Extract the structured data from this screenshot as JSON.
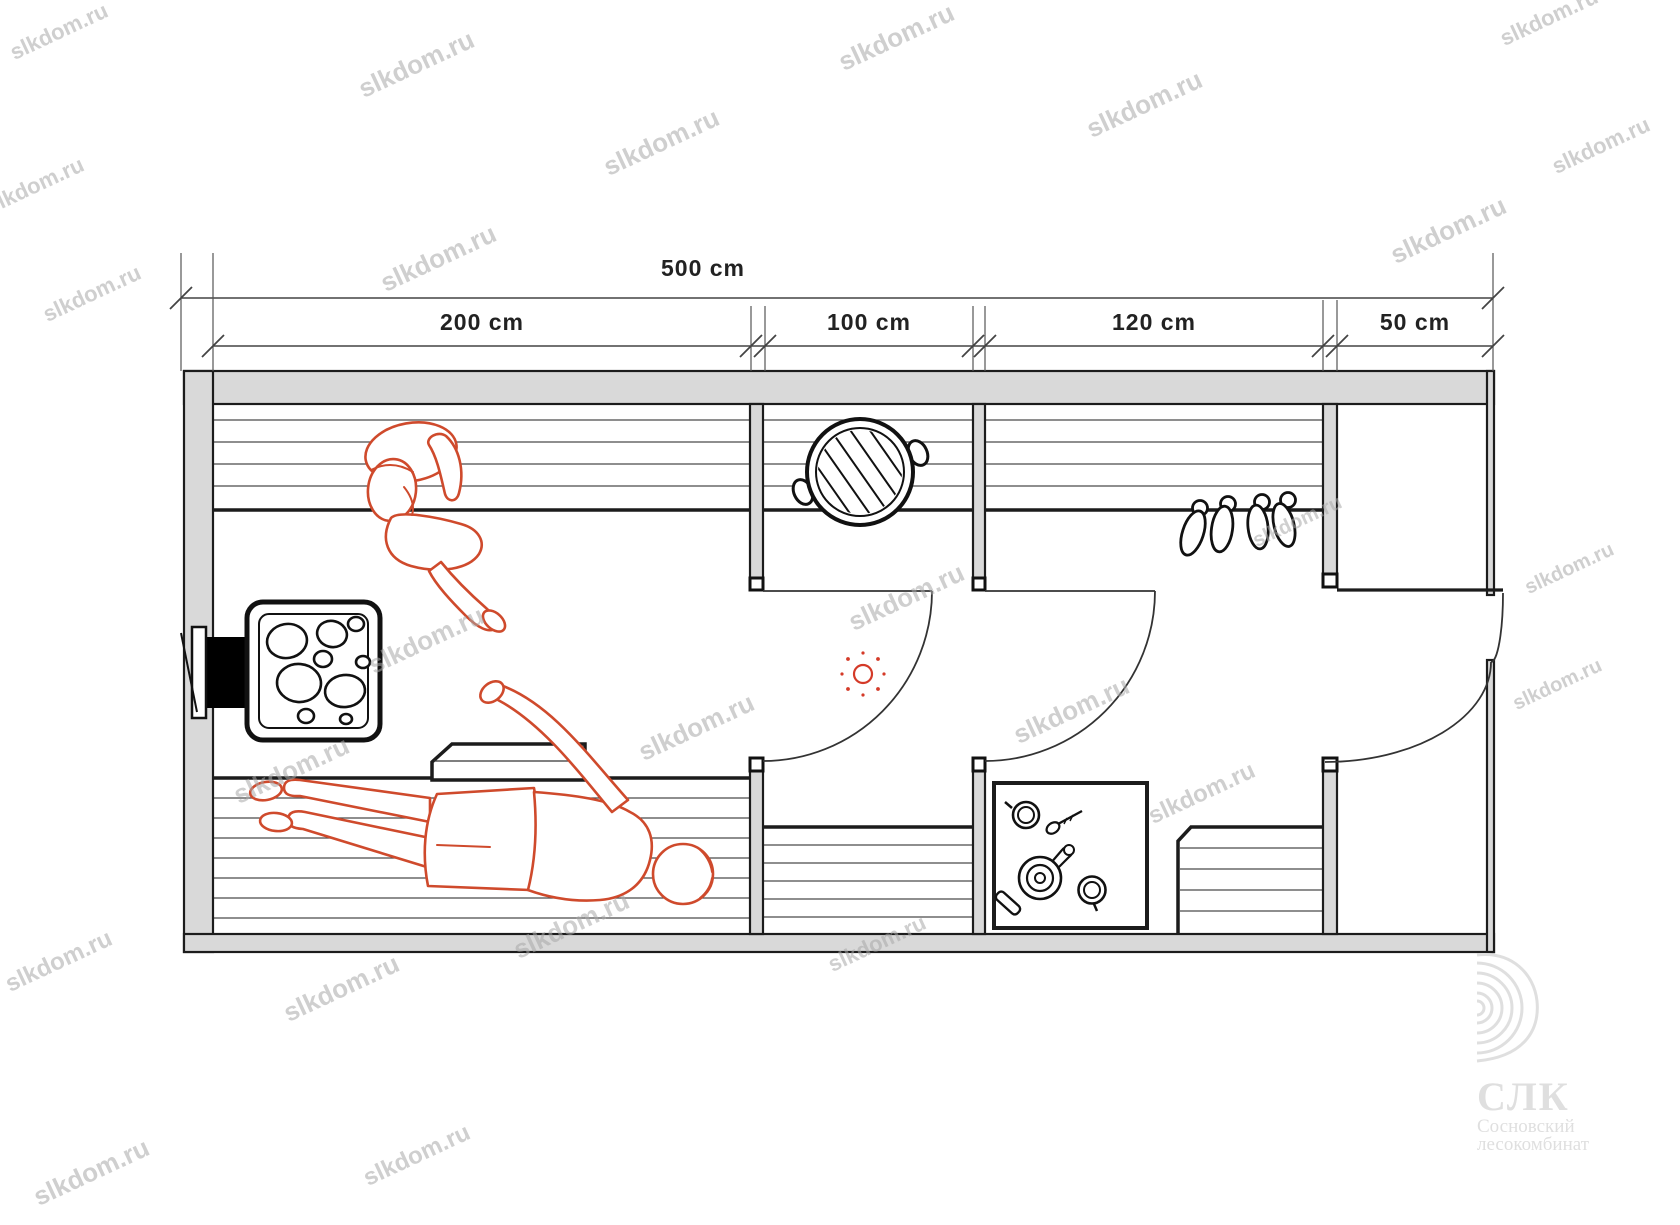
{
  "dimensions": {
    "total": "500 cm",
    "segments": [
      "200 cm",
      "100 cm",
      "120 cm",
      "50 cm"
    ]
  },
  "watermark": {
    "text": "slkdom.ru"
  },
  "logo": {
    "abbr": "СЛК",
    "name_line1": "Сосновский",
    "name_line2": "лесокомбинат"
  },
  "colors": {
    "figure": "#cf4a2c",
    "light_symbol": "#d43a28",
    "wall_fill": "#d9d9d9",
    "watermark": "#a8a8a8",
    "logo": "#dfdfdf"
  }
}
